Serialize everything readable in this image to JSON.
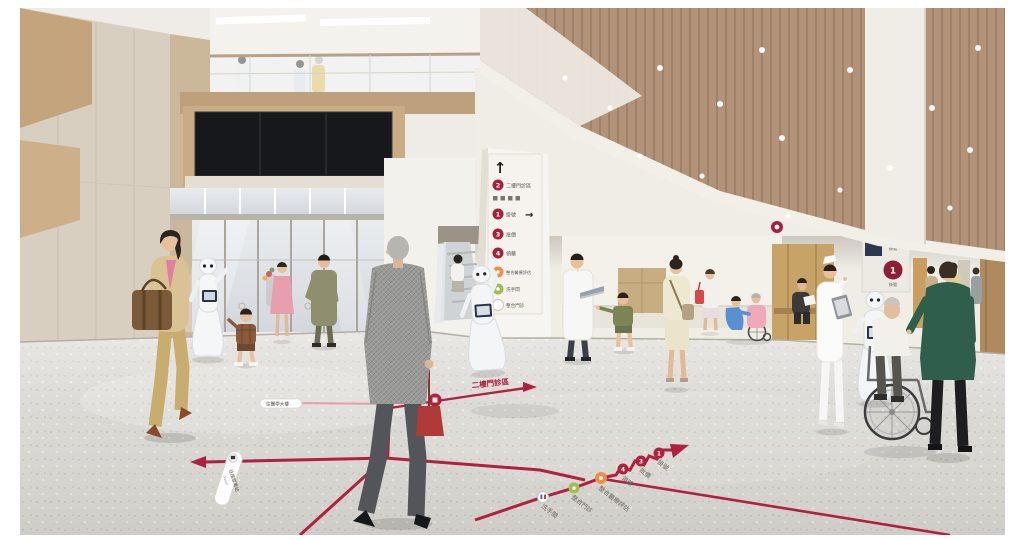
{
  "page": {
    "background": "#ffffff"
  },
  "palette": {
    "wayfinding_red": "#b0203f",
    "sign_red": "#a81e3c",
    "sign_orange": "#ee8f44",
    "sign_green": "#9dbf4e",
    "wood_ceiling": "#b2937a",
    "floor_gray": "#d7d5d0",
    "led_red": "#ff2d00"
  },
  "column_directory_sign": {
    "up_arrow": "↑",
    "items": [
      {
        "badge": "2",
        "badge_color": "#a81e3c",
        "label": "二樓門診區"
      },
      {
        "badge": "1",
        "badge_color": "#a81e3c",
        "label": "掛號",
        "arrow": "→"
      },
      {
        "badge": "3",
        "badge_color": "#a81e3c",
        "label": "批價"
      },
      {
        "badge": "4",
        "badge_color": "#a81e3c",
        "label": "領藥"
      },
      {
        "badge": "",
        "badge_color": "#ee8f44",
        "label": "整合醫療評估"
      },
      {
        "badge": "",
        "badge_color": "#9dbf4e",
        "label": "洗手間"
      },
      {
        "badge": "",
        "badge_color": "#ffffff",
        "label": "整合門診"
      }
    ]
  },
  "floor_wayfinding": {
    "line_color": "#b0203f",
    "second_floor_label": "二樓門診區",
    "route_stops": [
      {
        "badge": "",
        "color": "#ffffff",
        "label": "洗手間"
      },
      {
        "badge": "",
        "color": "#9dbf4e",
        "label": "整合門診"
      },
      {
        "badge": "",
        "color": "#ee8f44",
        "label": "整合醫療評估"
      },
      {
        "badge": "4",
        "color": "#b0203f",
        "label": "領藥"
      },
      {
        "badge": "3",
        "color": "#b0203f",
        "label": "批價"
      },
      {
        "badge": "1",
        "color": "#b0203f",
        "label": "掛號"
      }
    ],
    "transit_pill": {
      "label": "往接駁車站",
      "sub": "Transit"
    },
    "direction_pill": {
      "label": "往醫學大樓"
    }
  },
  "queue_display": {
    "value": "0067"
  },
  "hanging_counter_sign": {
    "badges": [
      {
        "number": "1",
        "caption": "掛號"
      },
      {
        "number": "1",
        "caption": "掛號"
      }
    ]
  },
  "scene_elements": [
    "woman-with-handbag",
    "pepper-robot-greeting",
    "boy-waving",
    "man-olive-coat",
    "woman-with-bouquet",
    "man-tweed-suit",
    "pepper-robot-center",
    "escalator-passenger",
    "doctor-with-laptop",
    "boy-pointing",
    "woman-cream-suit",
    "woman-red-bag",
    "nurse-with-wheelchair-patient",
    "man-reading",
    "nurse-with-clipboard",
    "pepper-robot-right",
    "elderly-man-wheelchair",
    "woman-green-jacket",
    "corridor-visitors",
    "mezzanine-visitors",
    "video-wall",
    "escalator",
    "entrance-doors"
  ]
}
